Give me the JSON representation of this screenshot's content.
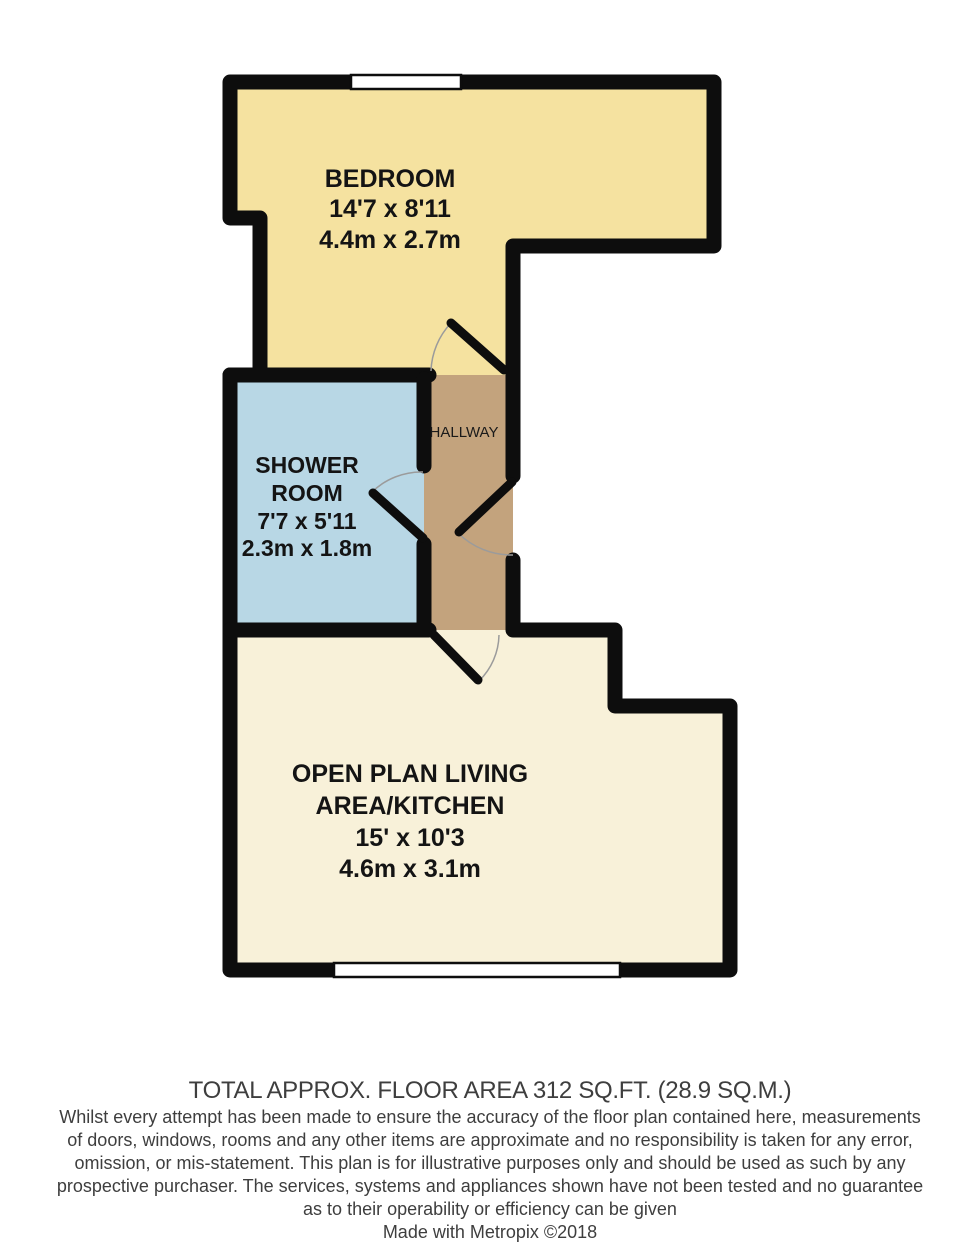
{
  "rooms": {
    "bedroom": {
      "name": "BEDROOM",
      "size_imperial": "14'7 x 8'11",
      "size_metric": "4.4m x 2.7m",
      "color": "#F5E2A0"
    },
    "shower_room": {
      "name_line1": "SHOWER",
      "name_line2": "ROOM",
      "size_imperial": "7'7 x 5'11",
      "size_metric": "2.3m x 1.8m",
      "color": "#B8D7E5"
    },
    "hallway": {
      "name": "HALLWAY",
      "color": "#C3A37D"
    },
    "living_area": {
      "name_line1": "OPEN PLAN LIVING",
      "name_line2": "AREA/KITCHEN",
      "size_imperial": "15' x 10'3",
      "size_metric": "4.6m x 3.1m",
      "color": "#F8F1D9"
    }
  },
  "footer": {
    "total_area": "TOTAL APPROX. FLOOR AREA 312 SQ.FT. (28.9 SQ.M.)",
    "disclaimer_lines": [
      "Whilst every attempt has been made to ensure the accuracy of the floor plan contained here, measurements",
      "of doors, windows, rooms and any other items are approximate and no responsibility is taken for any error,",
      "omission, or mis-statement. This plan is for illustrative purposes only and should be used as such by any",
      "prospective purchaser. The services, systems and appliances shown have not been tested and no guarantee",
      "as to their operability or efficiency can be given"
    ],
    "credit": "Made with Metropix ©2018"
  },
  "colors": {
    "wall": "#0d0d0d",
    "window": "#ffffff",
    "door_arc": "#9b9b9b",
    "background": "#ffffff"
  }
}
